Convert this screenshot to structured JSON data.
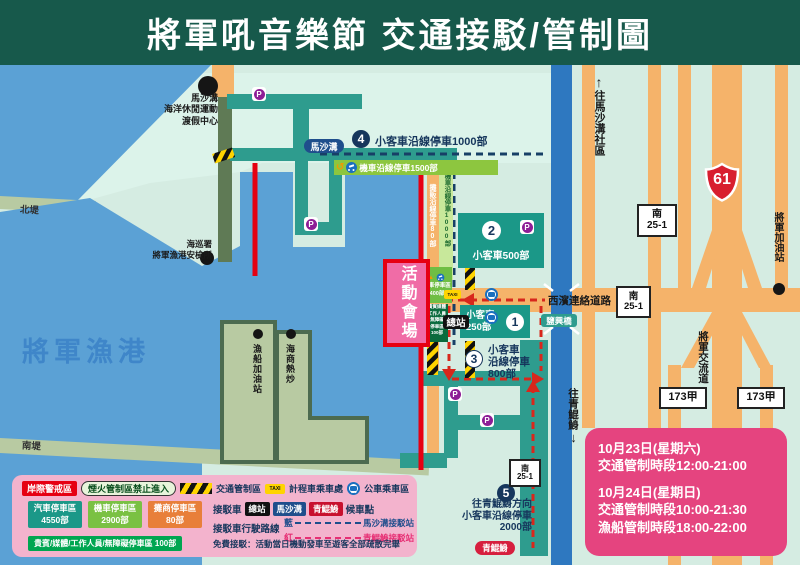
{
  "title": "將軍吼音樂節  交通接駁/管制圖",
  "icons": {
    "parking_letter": "P",
    "taxi": "TAXI",
    "up_arrow": "↑",
    "down_arrow": "↓",
    "recycle": "↺",
    "warn_triangle": "▲"
  },
  "map": {
    "harbor": "將軍漁港",
    "north_dike": "北堤",
    "south_dike": "南堤",
    "resort": "馬沙溝\n海洋休閒運動\n渡假中心",
    "coast_guard": "海巡署\n將軍漁港安檢所",
    "fuel_station": "漁船加油站",
    "seafood": "海商熱炒",
    "to_masago": "往馬沙溝社區",
    "to_qingkunshen": "往青鯤鯓",
    "xibin_road": "西濱連絡道路",
    "yanxing_bridge": "鹽興橋",
    "jiangjun_interchange": "將軍交流道",
    "jiangjun_gas": "將軍加油站",
    "hwy61": "61",
    "sign_nan": "南",
    "sign_251": "25-1",
    "sign_173": "173甲",
    "venue": "活動會場",
    "terminal": "總站",
    "masago_badge": "馬沙溝",
    "qingkunshen_badge": "青鯤鯓"
  },
  "parking": {
    "p1_num": "1",
    "p1_text": "小客車\n250部",
    "p2_num": "2",
    "p2_text": "小客車500部",
    "p3_num": "3",
    "p3_text": "小客車\n沿線停車\n800部",
    "p4_num": "4",
    "p4_text": "小客車沿線停車1000部",
    "p5_num": "5",
    "p5_text": "往青鯤鯓方向\n小客車沿線停車\n2000部",
    "moto1500": "機車沿線停車1500部",
    "moto1000": "機車沿線停車1000部",
    "moto400": "機車停車區\n400部",
    "vendor80": "攤販沿線停車80部",
    "vip_small": "貴賓媒體\n工作人員\n無障礙\n停車區\n100部"
  },
  "legend": {
    "coastal": "岸際警戒區",
    "fireworks": "煙火管制區禁止進入",
    "traffic_zone": "交通管制區",
    "taxi_label": "計程車乘車處",
    "bus_label": "公車乘車區",
    "car_box": "汽車停車區\n4550部",
    "moto_box": "機車停車區\n2900部",
    "vendor_box": "攤商停車區\n80部",
    "vip_box": "貴賓/媒體/工作人員/無障礙停車區 100部",
    "shuttle_prefix": "接駁車",
    "stop_terminal": "總站",
    "stop_masago": "馬沙溝",
    "stop_qks": "青鯤鯓",
    "shuttle_suffix": "候車點",
    "route_label": "接駁車行駛路線",
    "route_blue": "藍",
    "route_blue_dest": "馬沙溝接駁站",
    "route_red": "紅",
    "route_red_dest": "青鯤鯓接駁站",
    "free_shuttle": "免費接駁：活動當日機動發車至遊客全部疏散完畢"
  },
  "info_box": {
    "d1": "10月23日(星期六)",
    "t1": "交通管制時段12:00-21:00",
    "d2": "10月24日(星期日)",
    "t2": "交通管制時段10:00-21:30",
    "t3": "漁船管制時段18:00-22:00"
  }
}
